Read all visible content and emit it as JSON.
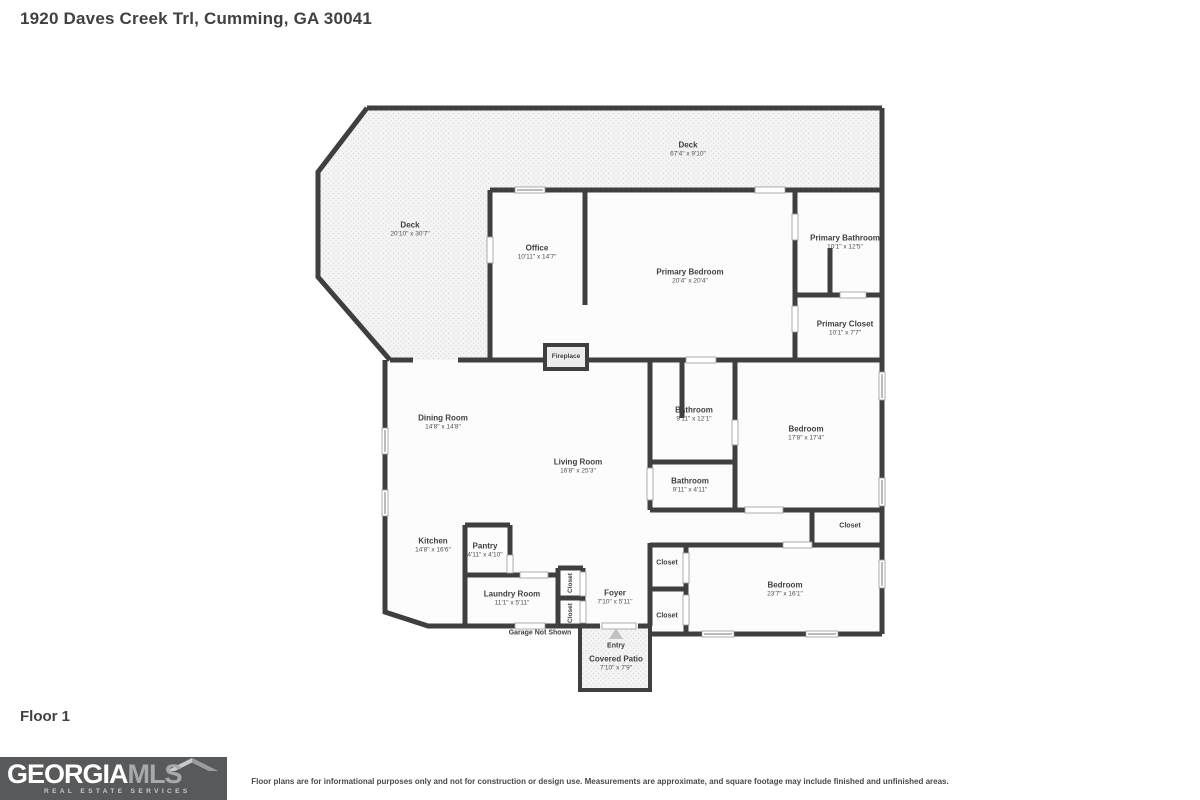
{
  "page": {
    "title": "1920 Daves Creek Trl, Cumming, GA 30041",
    "floor_label": "Floor 1",
    "disclaimer": "Floor plans are for informational purposes only and not for construction or design use. Measurements are approximate, and square footage may include finished and unfinished areas."
  },
  "logo": {
    "brand_primary": "GEORGIA",
    "brand_secondary": "MLS",
    "tagline": "REAL ESTATE SERVICES"
  },
  "colors": {
    "wall": "#3f3f3f",
    "deck_fill": "#f4f4f4",
    "room_fill": "#fcfcfc",
    "logo_background": "#58595b"
  },
  "rooms": {
    "deck_top": {
      "name": "Deck",
      "dims": "67'4\" x 9'10\""
    },
    "deck_left": {
      "name": "Deck",
      "dims": "20'10\" x 30'7\""
    },
    "office": {
      "name": "Office",
      "dims": "10'11\" x 14'7\""
    },
    "primary_bedroom": {
      "name": "Primary Bedroom",
      "dims": "20'4\" x 20'4\""
    },
    "primary_bathroom": {
      "name": "Primary Bathroom",
      "dims": "10'1\" x 12'5\""
    },
    "primary_closet": {
      "name": "Primary Closet",
      "dims": "10'1\" x 7'7\""
    },
    "fireplace": {
      "name": "Fireplace"
    },
    "dining_room": {
      "name": "Dining Room",
      "dims": "14'8\" x 14'8\""
    },
    "living_room": {
      "name": "Living Room",
      "dims": "16'8\" x 25'3\""
    },
    "bathroom_upper": {
      "name": "Bathroom",
      "dims": "9'11\" x 12'1\""
    },
    "bedroom_right": {
      "name": "Bedroom",
      "dims": "17'8\" x 17'4\""
    },
    "bathroom_lower": {
      "name": "Bathroom",
      "dims": "9'11\" x 4'11\""
    },
    "closet_right": {
      "name": "Closet"
    },
    "kitchen": {
      "name": "Kitchen",
      "dims": "14'8\" x 16'6\""
    },
    "pantry": {
      "name": "Pantry",
      "dims": "4'11\" x 4'10\""
    },
    "laundry_room": {
      "name": "Laundry Room",
      "dims": "11'1\" x 5'11\""
    },
    "closet_hall_upper": {
      "name": "Closet"
    },
    "closet_hall_lower": {
      "name": "Closet"
    },
    "closet_bed_upper": {
      "name": "Closet"
    },
    "closet_bed_lower": {
      "name": "Closet"
    },
    "foyer": {
      "name": "Foyer",
      "dims": "7'10\" x 5'11\""
    },
    "bedroom_lower": {
      "name": "Bedroom",
      "dims": "23'7\" x 16'1\""
    },
    "garage_note": {
      "name": "Garage Not Shown"
    },
    "entry": {
      "name": "Entry"
    },
    "covered_patio": {
      "name": "Covered Patio",
      "dims": "7'10\" x 7'9\""
    }
  }
}
